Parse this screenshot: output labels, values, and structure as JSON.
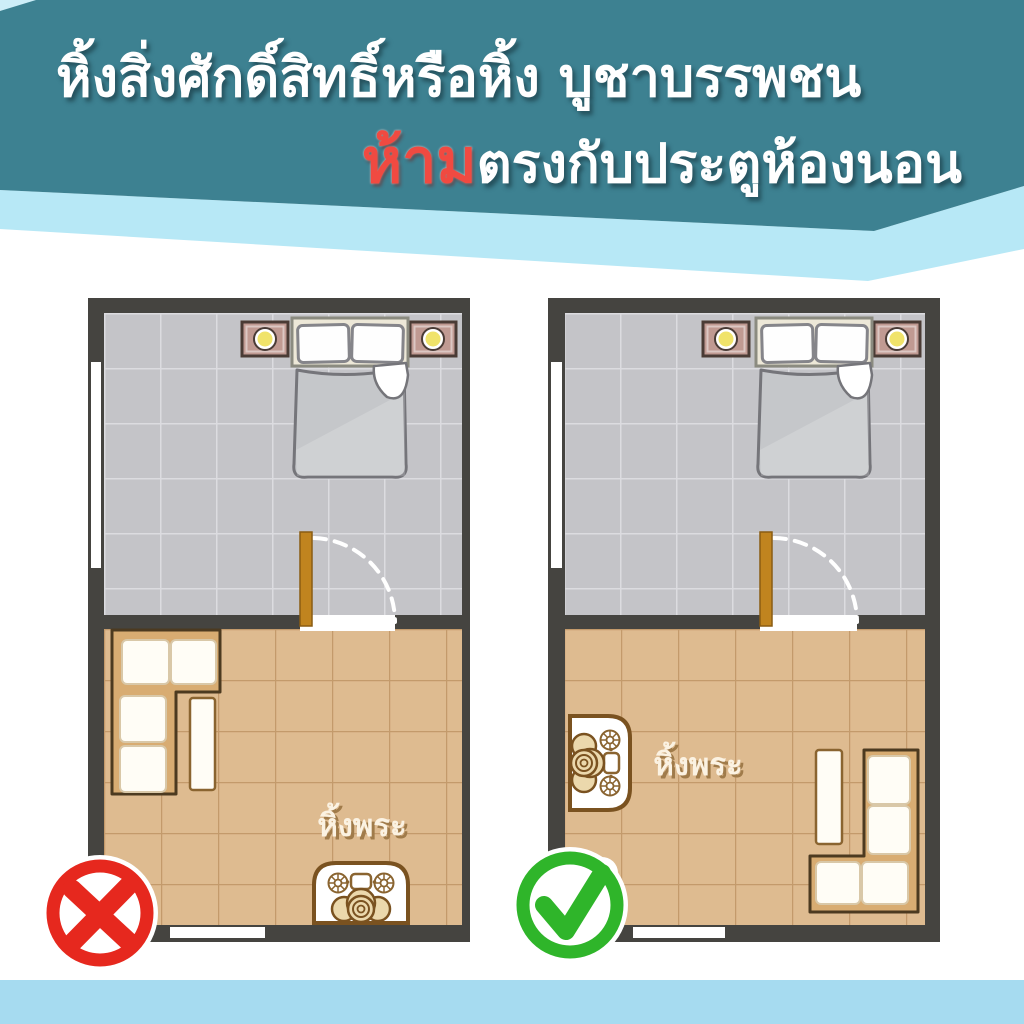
{
  "header": {
    "title_line1": "หิ้งสิ่งศักดิ์สิทธิ์หรือหิ้ง บูชาบรรพชน",
    "title_line2_highlight": "ห้าม",
    "title_line2_rest": "ตรงกับประตูห้องนอน"
  },
  "plans": {
    "wrong": {
      "verdict": "wrong",
      "shrine_label": "หิ้งพระ"
    },
    "correct": {
      "verdict": "correct",
      "shrine_label": "หิ้งพระ"
    }
  },
  "colors": {
    "header_teal": "#3D8191",
    "band_light_blue": "#B7E8F6",
    "footer_blue": "#A6DBF0",
    "wall_dark": "#454440",
    "bedroom_floor": "#C4C4C8",
    "bedroom_grid": "#DCDCE0",
    "living_floor": "#DEBB90",
    "living_grout": "#C39A6B",
    "door_brown": "#C0841F",
    "nightstand_tan": "#C09A92",
    "lamp_yellow": "#F0E36A",
    "sofa_base": "#D8AC72",
    "cushion_white": "#FFFDF6",
    "shrine_cream": "#EBD8AC",
    "label_cream": "#FBF2E2",
    "label_shadow": "#A07B4A",
    "wrong_red": "#E6281E",
    "correct_green": "#2FB52A",
    "title_red": "#F04A41"
  }
}
